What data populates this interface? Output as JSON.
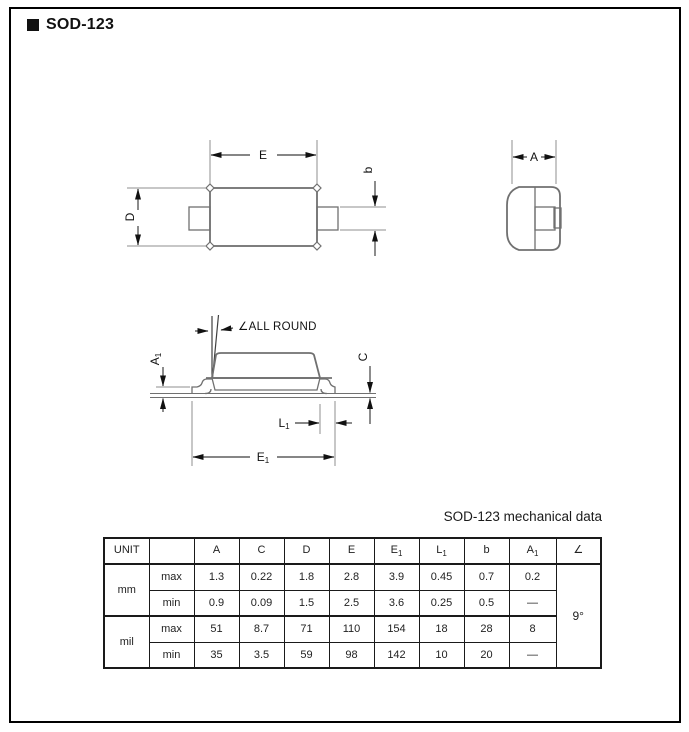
{
  "page": {
    "title": "SOD-123"
  },
  "drawing": {
    "labels": {
      "E": "E",
      "D": "D",
      "b": "b",
      "A": "A",
      "C": "C",
      "E1": {
        "base": "E",
        "sub": "1"
      },
      "L1": {
        "base": "L",
        "sub": "1"
      },
      "A1": {
        "base": "A",
        "sub": "1"
      },
      "all_round": "∠ALL ROUND"
    }
  },
  "table": {
    "caption": "SOD-123 mechanical data",
    "headers": [
      {
        "base": "UNIT",
        "sub": ""
      },
      {
        "base": "",
        "sub": ""
      },
      {
        "base": "A",
        "sub": ""
      },
      {
        "base": "C",
        "sub": ""
      },
      {
        "base": "D",
        "sub": ""
      },
      {
        "base": "E",
        "sub": ""
      },
      {
        "base": "E",
        "sub": "1"
      },
      {
        "base": "L",
        "sub": "1"
      },
      {
        "base": "b",
        "sub": ""
      },
      {
        "base": "A",
        "sub": "1"
      },
      {
        "base": "∠",
        "sub": ""
      }
    ],
    "groups": [
      {
        "unit": "mm",
        "rows": [
          {
            "label": "max",
            "values": [
              "1.3",
              "0.22",
              "1.8",
              "2.8",
              "3.9",
              "0.45",
              "0.7",
              "0.2"
            ]
          },
          {
            "label": "min",
            "values": [
              "0.9",
              "0.09",
              "1.5",
              "2.5",
              "3.6",
              "0.25",
              "0.5",
              "—"
            ]
          }
        ]
      },
      {
        "unit": "mil",
        "rows": [
          {
            "label": "max",
            "values": [
              "51",
              "8.7",
              "71",
              "110",
              "154",
              "18",
              "28",
              "8"
            ]
          },
          {
            "label": "min",
            "values": [
              "35",
              "3.5",
              "59",
              "98",
              "142",
              "10",
              "20",
              "—"
            ]
          }
        ]
      }
    ],
    "angle_value": "9°"
  }
}
